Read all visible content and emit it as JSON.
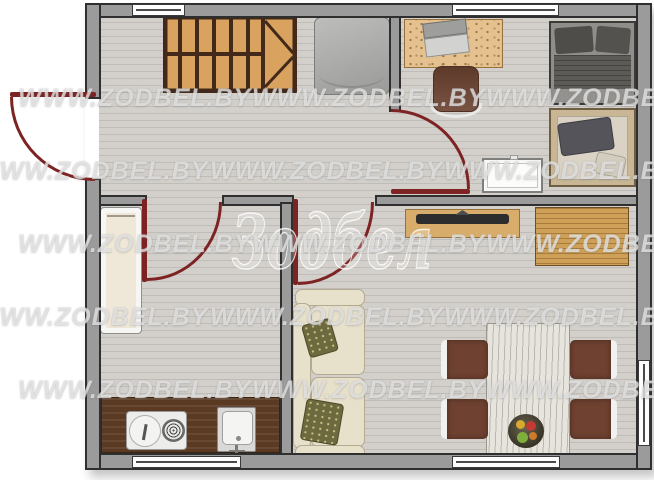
{
  "site_watermark": {
    "text": "WWW.ZODBEL.BY",
    "rows": [
      {
        "y": 84,
        "xs": [
          18,
          252,
          486
        ]
      },
      {
        "y": 157,
        "xs": [
          -25,
          210,
          444
        ]
      },
      {
        "y": 230,
        "xs": [
          18,
          252,
          486
        ]
      },
      {
        "y": 303,
        "xs": [
          -25,
          210,
          444
        ]
      },
      {
        "y": 376,
        "xs": [
          18,
          252,
          486
        ]
      }
    ]
  },
  "center_logo": {
    "text": "Зодбел"
  },
  "palette": {
    "wall_fill": "#9b9b9b",
    "wall_line": "#2f2f2f",
    "door": "#7e2323",
    "floor": "#d3d0cb",
    "floor_line": "#c0bdb8",
    "stair_wood": "#d9a35f",
    "stair_frame": "#42291a",
    "counter_wood": "#5a3a22",
    "oak": "#cfa057",
    "cream": "#e7e0cb",
    "olive": "#6e6a40",
    "background": "#ffffff"
  },
  "rooms": {
    "hall": [
      "staircase",
      "gray-cabinet",
      "front-door"
    ],
    "bedroom": [
      "desk",
      "laptop",
      "office-chair",
      "bed-gray",
      "bed-wood-frame",
      "crib"
    ],
    "kitchen": [
      "cream-table",
      "counter",
      "stove",
      "sink"
    ],
    "living_room": [
      "tv-console",
      "tv",
      "wardrobe",
      "sofa",
      "olive-pillows",
      "dining-table",
      "fruit-bowl",
      "chair",
      "chair",
      "chair",
      "chair"
    ]
  }
}
